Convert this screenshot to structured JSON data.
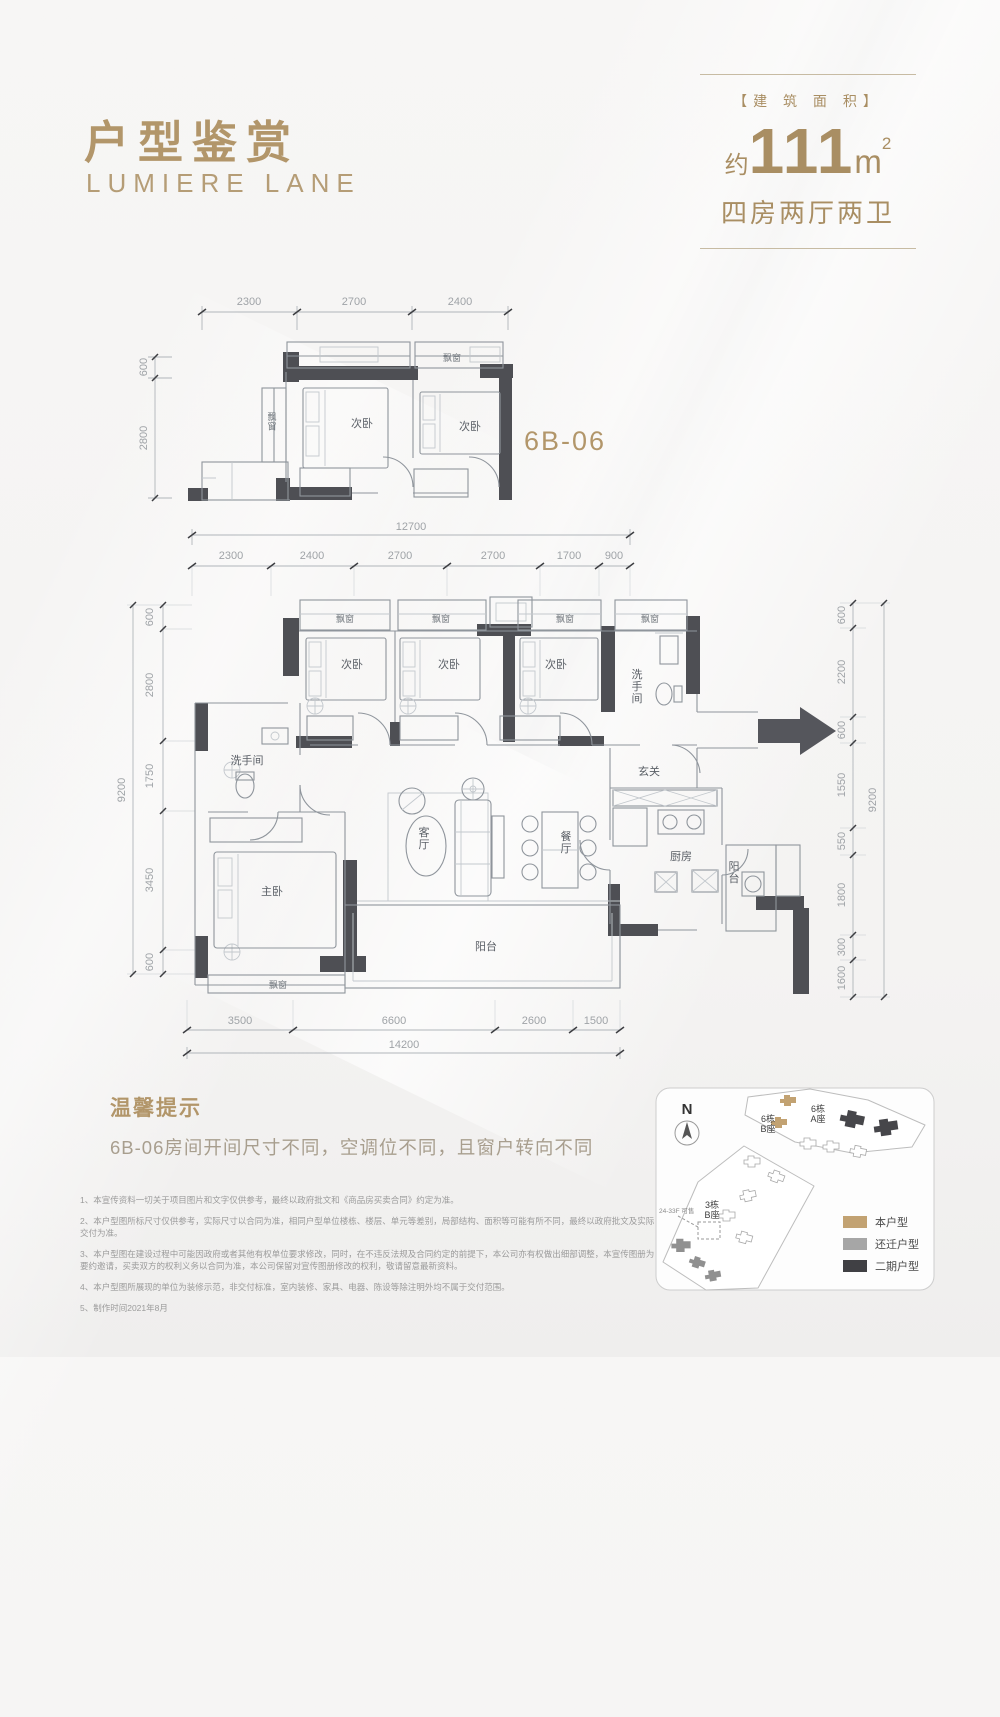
{
  "accent": "#b2966a",
  "header": {
    "title": "户型鉴赏",
    "subtitle": "LUMIERE LANE",
    "area_tag": "【建 筑 面 积】",
    "approx": "约",
    "area_value": "111",
    "area_unit": "m",
    "area_sup": "2",
    "layout": "四房两厅两卫"
  },
  "unit_label": "6B-06",
  "rooms": {
    "bay": "飘窗",
    "bed": "次卧",
    "master": "主卧",
    "bath": "洗手间",
    "entry": "玄关",
    "living": "客厅",
    "dining": "餐厅",
    "kitchen": "厨房",
    "balcony": "阳台"
  },
  "small_plan": {
    "dims_top": [
      "2300",
      "2700",
      "2400"
    ],
    "dims_left": [
      "600",
      "2800"
    ]
  },
  "main_plan": {
    "dim_top_total": "12700",
    "dims_top": [
      "2300",
      "2400",
      "2700",
      "2700",
      "1700",
      "900"
    ],
    "dims_left": [
      "600",
      "2800",
      "1750",
      "3450",
      "600"
    ],
    "dim_left_total": "9200",
    "dims_right": [
      "600",
      "2200",
      "600",
      "1550",
      "550",
      "1800",
      "300",
      "1600"
    ],
    "dim_right_total": "9200",
    "dims_bottom": [
      "3500",
      "6600",
      "2600",
      "1500"
    ],
    "dim_bottom_total": "14200"
  },
  "tips": {
    "title": "温馨提示",
    "content": "6B-06房间开间尺寸不同，空调位不同，且窗户转向不同"
  },
  "disclaimers": [
    "1、本宣传资料一切关于项目图片和文字仅供参考，最终以政府批文和《商品房买卖合同》约定为准。",
    "2、本户型图所标尺寸仅供参考，实际尺寸以合同为准，相同户型单位楼栋、楼层、单元等差别，局部结构、面积等可能有所不同，最终以政府批文及实际交付为准。",
    "3、本户型图在建设过程中可能因政府或者其他有权单位要求修改，同时，在不违反法规及合同约定的前提下，本公司亦有权做出细部调整，本宣传图册为要约邀请，买卖双方的权利义务以合同为准，本公司保留对宣传图册修改的权利，敬请留意最新资料。",
    "4、本户型图所展现的单位为装修示范，非交付标准，室内装修、家具、电器、陈设等除注明外均不属于交付范围。",
    "5、制作时间2021年8月"
  ],
  "sitemap": {
    "north": "N",
    "bld_6b_line1": "6栋",
    "bld_6b_line2": "B座",
    "bld_6a_line1": "6栋",
    "bld_6a_line2": "A座",
    "bld_3b_line1": "3栋",
    "bld_3b_line2": "B座",
    "sale_note": "24-33F 可售",
    "legend": [
      {
        "label": "本户型",
        "color": "#c2a272"
      },
      {
        "label": "还迁户型",
        "color": "#a6a6a6"
      },
      {
        "label": "二期户型",
        "color": "#404044"
      }
    ]
  }
}
